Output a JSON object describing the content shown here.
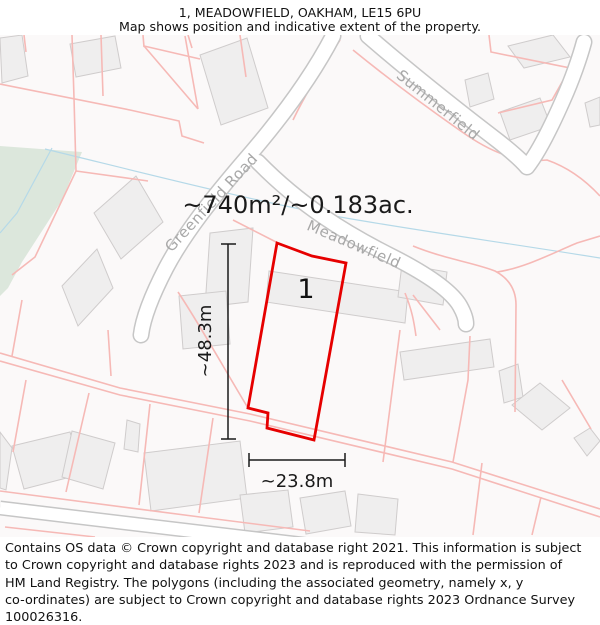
{
  "header": {
    "title": "1, MEADOWFIELD, OAKHAM, LE15 6PU",
    "subtitle": "Map shows position and indicative extent of the property."
  },
  "map": {
    "area_label": "~740m²/~0.183ac.",
    "plot_number": "1",
    "width_label": "~23.8m",
    "height_label": "~48.3m",
    "roads": [
      {
        "name": "Greenfield Road"
      },
      {
        "name": "Meadowfield"
      },
      {
        "name": "Summerfield"
      }
    ]
  },
  "footer": {
    "lines": [
      "Contains OS data © Crown copyright and database right 2021. This information is subject",
      "to Crown copyright and database rights 2023 and is reproduced with the permission of",
      "HM Land Registry. The polygons (including the associated geometry, namely x, y",
      "co-ordinates) are subject to Crown copyright and database rights 2023 Ordnance Survey",
      "100026316."
    ]
  },
  "colors": {
    "property_outline": "#e60000",
    "parcel_line": "#f6b9b6",
    "building_fill": "#efeeee",
    "building_edge": "#cfcccc",
    "road_edge": "#c6c6c6",
    "road_fill": "#ffffff",
    "green_area": "#dce7dc",
    "water_line": "#b5d9e8",
    "road_label_text": "#a8a8a8",
    "dimension_line": "#1a1a1a",
    "map_background": "#fbf9f9"
  }
}
